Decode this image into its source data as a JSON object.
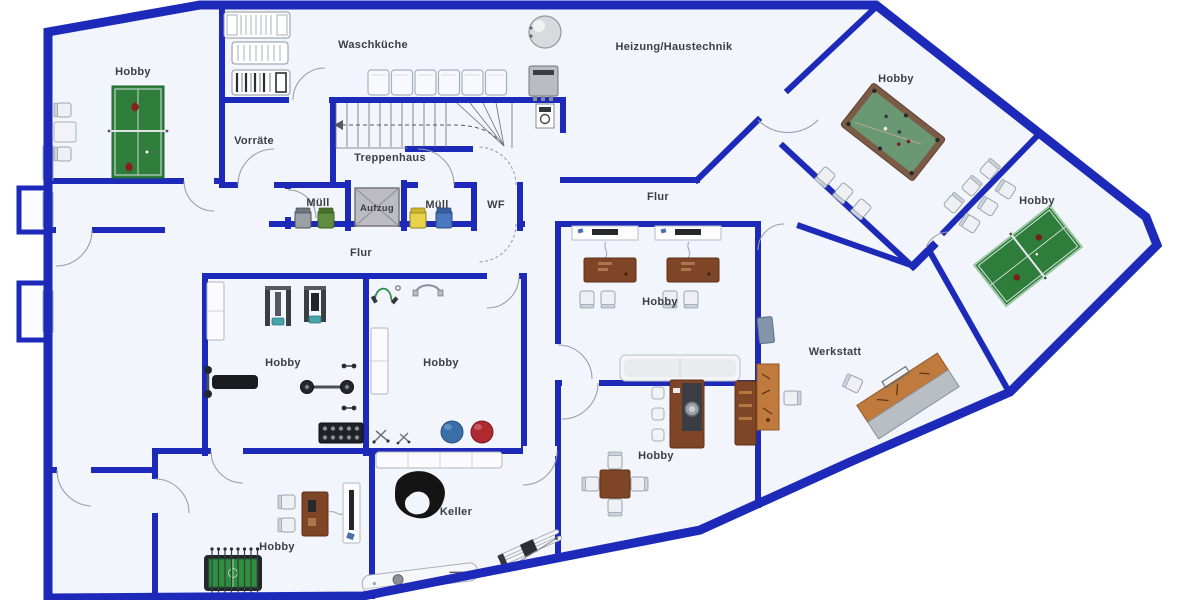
{
  "floorplan": {
    "type": "basement-floor-plan",
    "language": "de",
    "rooms": [
      {
        "id": "hobby-nw",
        "label": "Hobby",
        "furniture": [
          "table-tennis-table",
          "chairs",
          "side-table",
          "window"
        ]
      },
      {
        "id": "waschkueche",
        "label": "Waschküche",
        "furniture": [
          "drying-racks",
          "washing-machines"
        ]
      },
      {
        "id": "heizung-haustechnik",
        "label": "Heizung/Haustechnik",
        "furniture": [
          "boiler-tank",
          "heating-unit",
          "water-meter"
        ]
      },
      {
        "id": "hobby-billiard",
        "label": "Hobby",
        "furniture": [
          "billiard-table",
          "chairs"
        ]
      },
      {
        "id": "hobby-table-tennis-east",
        "label": "Hobby",
        "furniture": [
          "table-tennis-table",
          "chairs"
        ]
      },
      {
        "id": "vorraete",
        "label": "Vorräte",
        "furniture": []
      },
      {
        "id": "treppenhaus",
        "label": "Treppenhaus",
        "furniture": [
          "staircase"
        ]
      },
      {
        "id": "muell-west",
        "label": "Müll",
        "furniture": [
          "waste-bin-gray",
          "waste-bin-green"
        ]
      },
      {
        "id": "aufzug",
        "label": "Aufzug",
        "furniture": [
          "elevator-car"
        ]
      },
      {
        "id": "muell-east",
        "label": "Müll",
        "furniture": [
          "waste-bin-yellow",
          "waste-bin-blue"
        ]
      },
      {
        "id": "wf",
        "label": "WF",
        "furniture": []
      },
      {
        "id": "flur-east",
        "label": "Flur",
        "furniture": []
      },
      {
        "id": "flur-west",
        "label": "Flur",
        "furniture": []
      },
      {
        "id": "hobby-gym",
        "label": "Hobby",
        "furniture": [
          "strength-machines",
          "weight-bench",
          "barbell",
          "dumbbell-rack",
          "cabinet"
        ]
      },
      {
        "id": "hobby-fitness",
        "label": "Hobby",
        "furniture": [
          "jump-rope",
          "resistance-band",
          "cabinet",
          "exercise-ball-blue",
          "exercise-ball-red"
        ]
      },
      {
        "id": "hobby-office",
        "label": "Hobby",
        "furniture": [
          "wall-shelves",
          "desks",
          "chairs",
          "couch"
        ]
      },
      {
        "id": "werkstatt",
        "label": "Werkstatt",
        "furniture": [
          "workbench",
          "work-chair",
          "angled-workbench",
          "floor-mat"
        ]
      },
      {
        "id": "hobby-bar",
        "label": "Hobby",
        "furniture": [
          "bar-counter",
          "bar-stools",
          "cabinet",
          "dining-table",
          "chairs"
        ]
      },
      {
        "id": "hobby-games",
        "label": "Hobby",
        "furniture": [
          "foosball-table",
          "desk",
          "chairs",
          "tv-stand"
        ]
      },
      {
        "id": "keller",
        "label": "Keller",
        "furniture": [
          "sideboard",
          "inner-tube",
          "skis",
          "sled"
        ]
      }
    ],
    "colors": {
      "wall": "#1d2ab9",
      "floor": "#f2f5fb",
      "background": "#ffffff",
      "label_text": "#3a3f46",
      "table_tennis_green": "#2e7d3a",
      "billiard_felt": "#6a9873",
      "wood_dark": "#7e4526",
      "wood_workbench": "#c07a3d",
      "exercise_ball_blue": "#3a6ea8",
      "exercise_ball_red": "#b02830",
      "bin_gray": "#9aa0a8",
      "bin_green": "#5f8f3e",
      "bin_yellow": "#e8d24a",
      "bin_blue": "#4a78c0",
      "elevator_gray": "#bcbcc2"
    }
  }
}
